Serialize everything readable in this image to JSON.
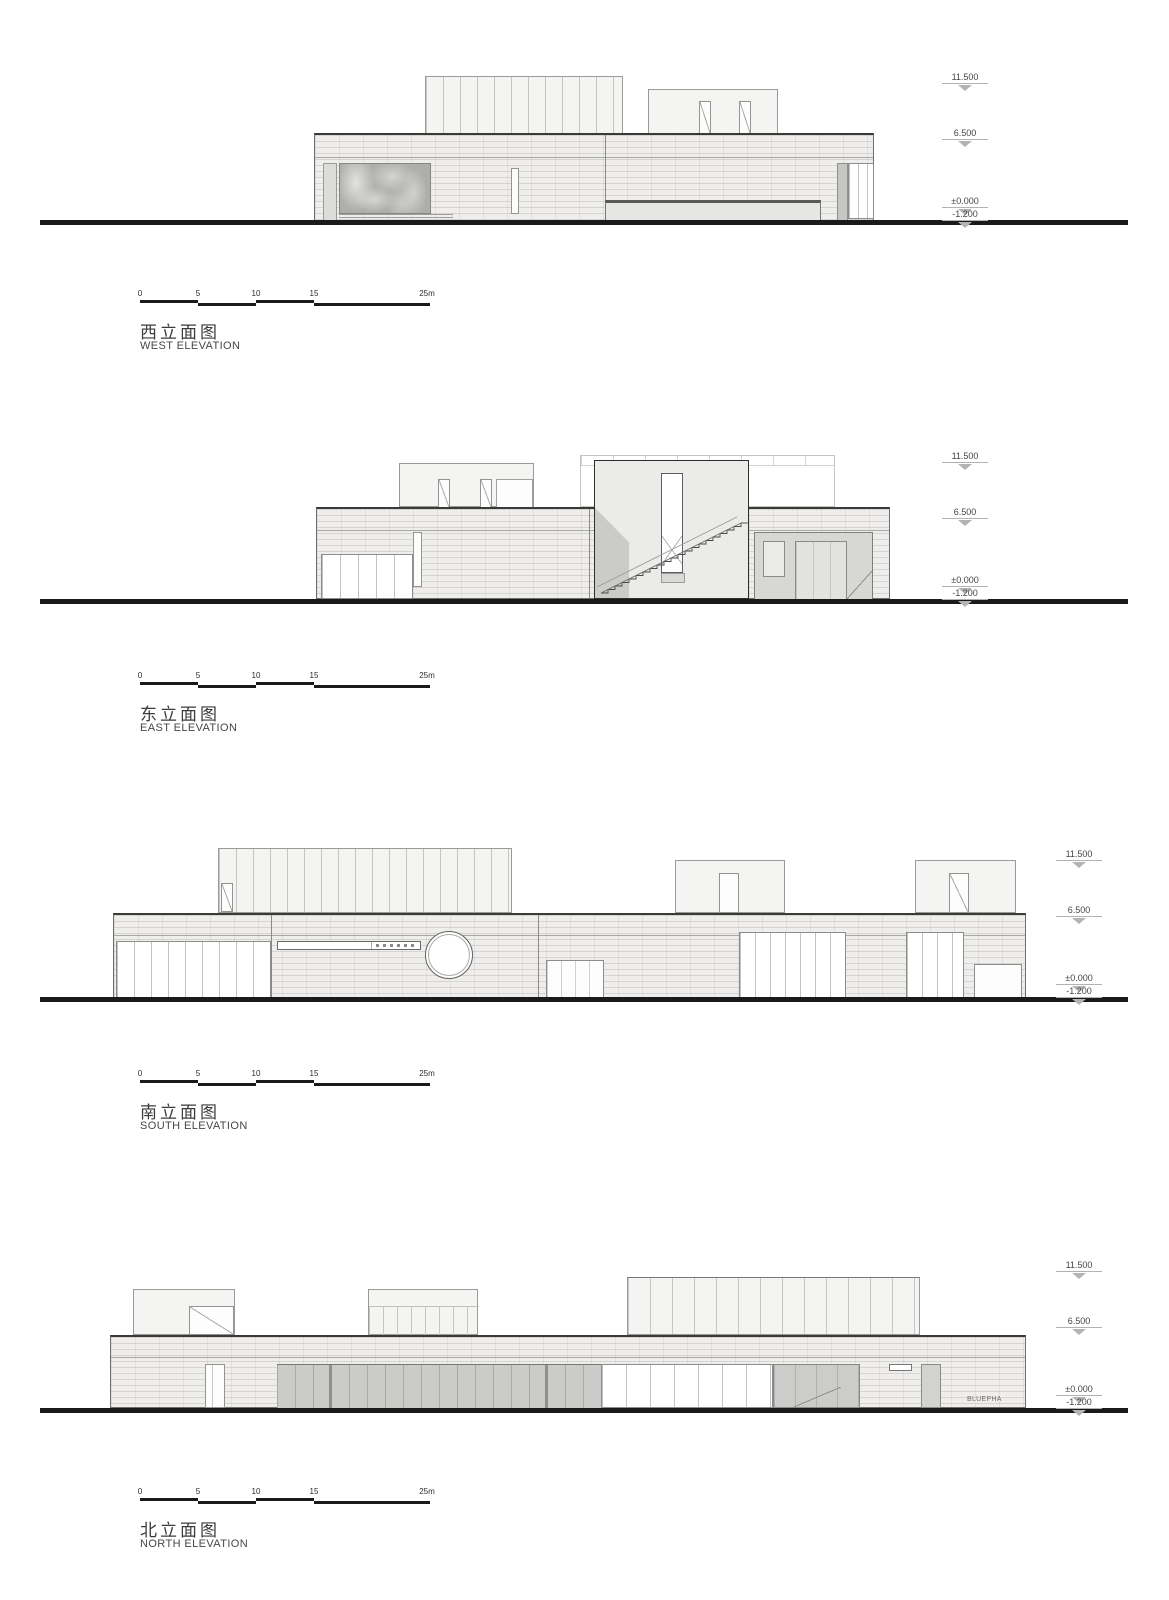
{
  "document": {
    "type": "architectural elevation sheet",
    "watermark": "BLUEPHA"
  },
  "colors": {
    "paper": "#ffffff",
    "ground_line": "#1a1a1a",
    "masonry_fill": "#efeeec",
    "glass_dark": "#aeaeac",
    "text": "#3b3b3b",
    "level_triangle": "#b4b4b2"
  },
  "scale_bar": {
    "labels": [
      "0",
      "5",
      "10",
      "15",
      "25m"
    ]
  },
  "sections": [
    {
      "title_zh": "西立面图",
      "title_en": "WEST ELEVATION",
      "levels": [
        "11.500",
        "6.500",
        "±0.000",
        "-1.200"
      ]
    },
    {
      "title_zh": "东立面图",
      "title_en": "EAST ELEVATION",
      "levels": [
        "11.500",
        "6.500",
        "±0.000",
        "-1.200"
      ]
    },
    {
      "title_zh": "南立面图",
      "title_en": "SOUTH ELEVATION",
      "levels": [
        "11.500",
        "6.500",
        "±0.000",
        "-1.200"
      ]
    },
    {
      "title_zh": "北立面图",
      "title_en": "NORTH ELEVATION",
      "levels": [
        "11.500",
        "6.500",
        "±0.000",
        "-1.200"
      ],
      "watermark": "BLUEPHA"
    }
  ]
}
